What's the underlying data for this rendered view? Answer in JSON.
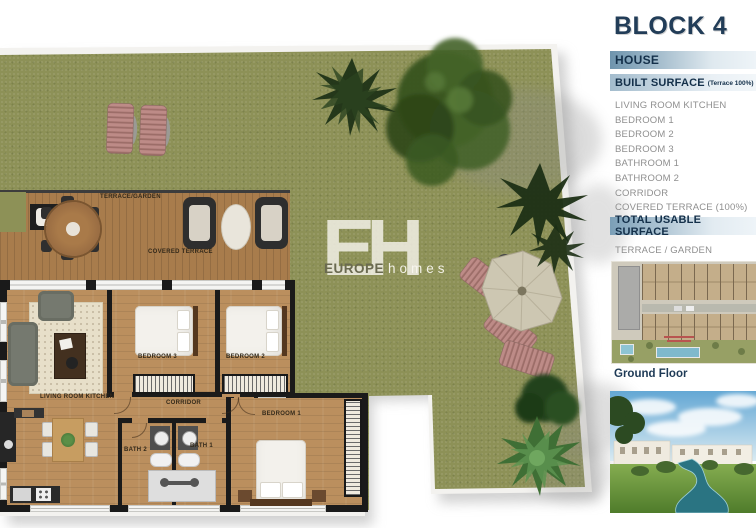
{
  "panel": {
    "title": "BLOCK 4",
    "subtitle": "HOUSE",
    "built_surface_label": "BUILT SURFACE",
    "built_surface_note": "(Terrace 100%)",
    "rooms": [
      "LIVING ROOM KITCHEN",
      "BEDROOM 1",
      "BEDROOM 2",
      "BEDROOM 3",
      "BATHROOM 1",
      "BATHROOM 2",
      "CORRIDOR",
      "COVERED TERRACE (100%)"
    ],
    "total_label": "TOTAL USABLE SURFACE",
    "terrace_garden_label": "TERRACE / GARDEN",
    "ground_floor_label": "Ground Floor"
  },
  "plan_labels": {
    "terrace_garden": "TERRACE/GARDEN",
    "covered_terrace": "COVERED TERRACE",
    "living": "LIVING ROOM KITCHEN",
    "corridor": "CORRIDOR",
    "bedroom1": "BEDROOM 1",
    "bedroom2": "BEDROOM 2",
    "bedroom3": "BEDROOM 3",
    "bath1": "BATH 1",
    "bath2": "BATH 2"
  },
  "watermark": {
    "initials": "EH",
    "name_bold": "EUROPE",
    "name_light": "homes"
  },
  "colors": {
    "accent_navy": "#1e3a56",
    "bar_blue": "#6e94ad",
    "grass_green": "#8d9157",
    "deck_wood": "#a87c4c",
    "floor_wood": "#bb8f5e",
    "water_teal": "#2a7482",
    "lounger_pink": "#bd8b87"
  }
}
